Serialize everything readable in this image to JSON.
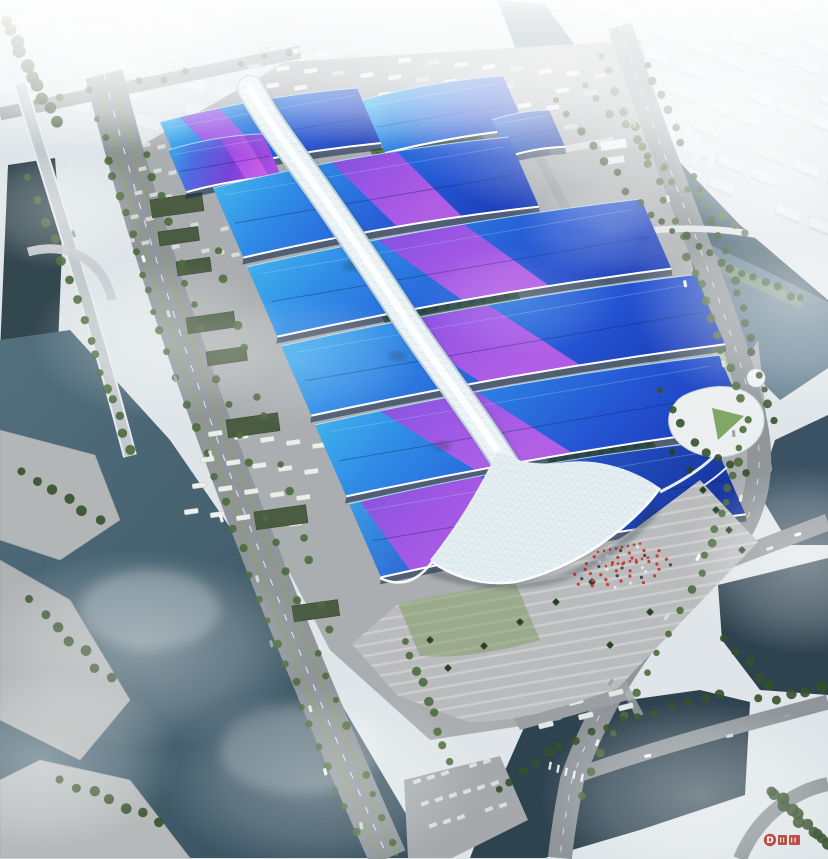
{
  "meta": {
    "domain": "Natural-Image",
    "subject": "aerial-rendering-exhibition-convention-center",
    "description": "Bird's-eye CGI masterplan rendering: rows of blue barrel-vault exhibition halls with purple ribbon roofs, a white serpentine central concourse canopy, south entrance plaza, rivers, canals, highways and a hazy city skyline.",
    "image_size": {
      "w": 828,
      "h": 859
    }
  },
  "watermark": {
    "letter": "D",
    "color": "#b5342c"
  },
  "palette": {
    "haze": "#e3e9ec",
    "ground": "#abaeb0",
    "ground_light": "#b8bbbc",
    "road": "#8f9599",
    "road_light": "#c9ced1",
    "lane": "#ffffff",
    "water": "#41596a",
    "water_deep": "#2e4350",
    "water_light": "#7e97a6",
    "lake": "#5f7b8d",
    "tree": "#4d6b3c",
    "tree_dark": "#35502c",
    "lawn": "#8aa468",
    "pitch": "#6f9a4e",
    "roof_cyan": "#45c6f0",
    "roof_blue": "#2e7ce2",
    "roof_deep": "#1d49c6",
    "ribbon_a": "#8f46dc",
    "ribbon_b": "#c558ea",
    "spine": "#e9f1f4",
    "spine_edge": "#b9ced8",
    "canopy": "#dfebef",
    "warehouse": "#4a5c41",
    "plaza": "#b9bbbc",
    "red": "#d23a30",
    "city": "#e9edef",
    "city_shadow": "#c3cdd2",
    "facade": "#16294d"
  },
  "scene": {
    "halls": [
      {
        "name": "north-hall-west",
        "o": [
          160,
          122
        ],
        "w": 200,
        "d": 60,
        "kind": "blue",
        "ribbon": [
          0.1,
          0.3,
          0.12
        ],
        "crown": 9
      },
      {
        "name": "north-hall-east",
        "o": [
          362,
          100
        ],
        "w": 143,
        "d": 58,
        "kind": "blue",
        "ribbon": null,
        "crown": 7
      },
      {
        "name": "north-hall-small-east",
        "o": [
          492,
          120
        ],
        "w": 58,
        "d": 40,
        "kind": "dark",
        "ribbon": null,
        "crown": 5
      },
      {
        "name": "north-hall-purple-annex",
        "o": [
          168,
          150
        ],
        "w": 96,
        "d": 46,
        "kind": "purple",
        "ribbon": [
          0.55,
          0.8,
          0.08
        ],
        "crown": 6
      },
      {
        "name": "hall-row-2",
        "o": [
          213,
          188
        ],
        "w": 300,
        "d": 76,
        "kind": "blue",
        "ribbon": [
          0.4,
          0.62,
          0.12
        ],
        "crown": 11
      },
      {
        "name": "hall-row-3",
        "o": [
          247,
          267
        ],
        "w": 400,
        "d": 76,
        "kind": "blue",
        "ribbon": [
          0.33,
          0.55,
          0.14
        ],
        "crown": 11
      },
      {
        "name": "hall-row-4",
        "o": [
          281,
          346
        ],
        "w": 420,
        "d": 76,
        "kind": "blue",
        "ribbon": [
          0.26,
          0.5,
          0.15
        ],
        "crown": 11
      },
      {
        "name": "hall-row-5",
        "o": [
          315,
          425
        ],
        "w": 410,
        "d": 78,
        "kind": "blue",
        "ribbon": [
          0.16,
          0.4,
          0.16
        ],
        "crown": 11
      },
      {
        "name": "south-hall",
        "o": [
          349,
          504
        ],
        "w": 370,
        "d": 80,
        "kind": "deep",
        "ribbon": [
          0.03,
          0.36,
          0.05
        ],
        "crown": 12
      }
    ],
    "green_strips": [
      {
        "o": [
          264,
          146
        ],
        "w": 55,
        "d": 10
      },
      {
        "o": [
          370,
          150
        ],
        "w": 112,
        "d": 12
      },
      {
        "o": [
          380,
          312
        ],
        "w": 138,
        "d": 12
      },
      {
        "o": [
          545,
          455
        ],
        "w": 108,
        "d": 13
      }
    ],
    "warehouses": [
      [
        150,
        200,
        52,
        18
      ],
      [
        158,
        232,
        40,
        14
      ],
      [
        176,
        262,
        34,
        14
      ],
      [
        206,
        352,
        40,
        14
      ],
      [
        186,
        318,
        48,
        16
      ],
      [
        226,
        420,
        52,
        18
      ],
      [
        254,
        512,
        52,
        18
      ],
      [
        292,
        606,
        46,
        16
      ]
    ],
    "palms": [
      [
        690,
        470
      ],
      [
        703,
        490
      ],
      [
        716,
        510
      ],
      [
        729,
        530
      ],
      [
        742,
        550
      ],
      [
        672,
        452
      ],
      [
        520,
        622
      ],
      [
        556,
        602
      ],
      [
        592,
        582
      ],
      [
        484,
        646
      ],
      [
        448,
        668
      ],
      [
        610,
        645
      ],
      [
        650,
        612
      ],
      [
        430,
        640
      ]
    ],
    "crowd": {
      "center": [
        622,
        568
      ],
      "count": 46
    }
  }
}
